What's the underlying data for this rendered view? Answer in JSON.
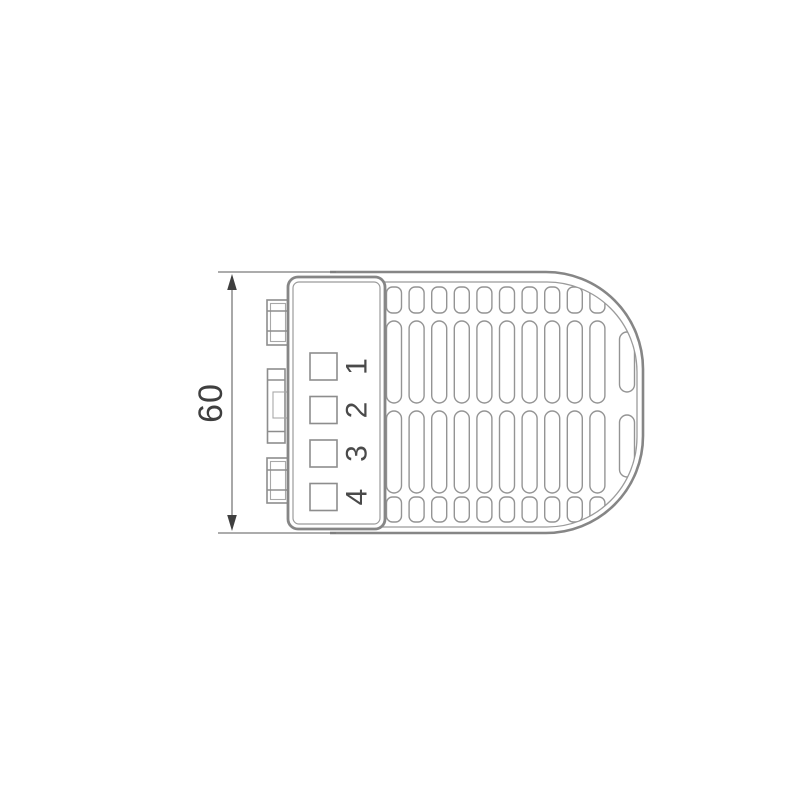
{
  "dimension": {
    "value": "60"
  },
  "terminal_block": {
    "slots": [
      {
        "number": "1"
      },
      {
        "number": "2"
      },
      {
        "number": "3"
      },
      {
        "number": "4"
      }
    ]
  },
  "grille": {
    "columns": 10,
    "column_start_x": 386.5,
    "column_pitch": 22.6,
    "slot_width": 15,
    "rows": [
      {
        "y": 287,
        "h": 26,
        "rx": 6
      },
      {
        "y": 321,
        "h": 82,
        "rx": 7.5
      },
      {
        "y": 411,
        "h": 82,
        "rx": 7.5
      },
      {
        "y": 497,
        "h": 25,
        "rx": 6
      }
    ],
    "right_column_slots": [
      {
        "x": 619.5,
        "y": 332,
        "w": 15,
        "h": 60,
        "rx": 7.5
      },
      {
        "x": 619.5,
        "y": 415,
        "w": 15,
        "h": 62,
        "rx": 7.5
      }
    ]
  },
  "colors": {
    "line": "#868686",
    "detail": "#9b9b9b",
    "dimension": "#7a7a7a",
    "accent": "#3f3f3f",
    "background": "#ffffff"
  }
}
